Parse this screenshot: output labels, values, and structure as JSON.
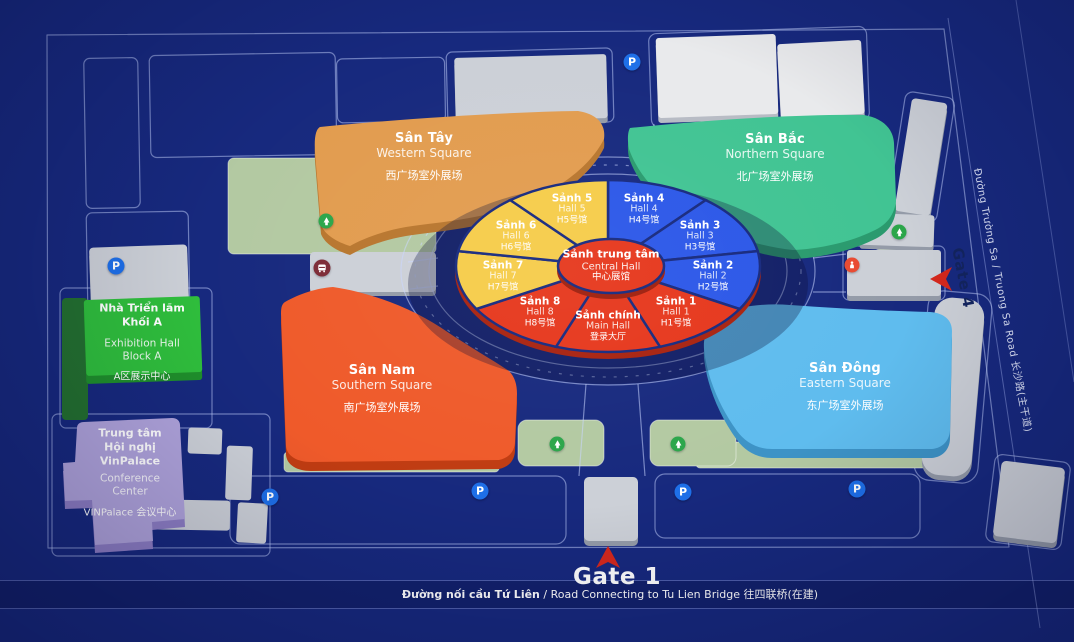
{
  "colors": {
    "background": "#17297E",
    "pie_blue": "#2B57E8",
    "pie_yellow": "#F6CC49",
    "pie_red": "#E6371C",
    "square_western": "#E29C4F",
    "square_northern": "#41C493",
    "square_southern": "#EF5A2A",
    "square_eastern": "#5FBCEE",
    "block_a_green": "#2FBE3C",
    "vinpalace_purple": "#AFA3DB",
    "parking_blue": "#1E6FE8",
    "tree_green": "#2BA64A",
    "gate_arrow_red": "#D5281C"
  },
  "central_hub": {
    "name": "Sảnh trung tâm",
    "en": "Central Hall",
    "cn": "中心展馆"
  },
  "halls": [
    {
      "id": "hall4",
      "name": "Sảnh 4",
      "en": "Hall 4",
      "cn": "H4号馆",
      "group": "blue",
      "start": 0,
      "end": 40
    },
    {
      "id": "hall3",
      "name": "Sảnh 3",
      "en": "Hall 3",
      "cn": "H3号馆",
      "group": "blue",
      "start": 40,
      "end": 80
    },
    {
      "id": "hall2",
      "name": "Sảnh 2",
      "en": "Hall 2",
      "cn": "H2号馆",
      "group": "blue",
      "start": 80,
      "end": 120
    },
    {
      "id": "hall1",
      "name": "Sảnh 1",
      "en": "Hall 1",
      "cn": "H1号馆",
      "group": "red",
      "start": 120,
      "end": 160
    },
    {
      "id": "main-hall",
      "name": "Sảnh chính",
      "en": "Main Hall",
      "cn": "登录大厅",
      "group": "red",
      "start": 160,
      "end": 200
    },
    {
      "id": "hall8",
      "name": "Sảnh 8",
      "en": "Hall 8",
      "cn": "H8号馆",
      "group": "red",
      "start": 200,
      "end": 240
    },
    {
      "id": "hall7",
      "name": "Sảnh 7",
      "en": "Hall 7",
      "cn": "H7号馆",
      "group": "yellow",
      "start": 240,
      "end": 280
    },
    {
      "id": "hall6",
      "name": "Sảnh 6",
      "en": "Hall 6",
      "cn": "H6号馆",
      "group": "yellow",
      "start": 280,
      "end": 320
    },
    {
      "id": "hall5",
      "name": "Sảnh 5",
      "en": "Hall 5",
      "cn": "H5号馆",
      "group": "yellow",
      "start": 320,
      "end": 360
    }
  ],
  "squares": {
    "western": {
      "name": "Sân Tây",
      "en": "Western Square",
      "cn": "西广场室外展场"
    },
    "northern": {
      "name": "Sân Bắc",
      "en": "Northern Square",
      "cn": "北广场室外展场"
    },
    "southern": {
      "name": "Sân Nam",
      "en": "Southern Square",
      "cn": "南广场室外展场"
    },
    "eastern": {
      "name": "Sân Đông",
      "en": "Eastern Square",
      "cn": "东广场室外展场"
    }
  },
  "buildings": {
    "block_a": {
      "name_line1": "Nhà Triển lãm",
      "name_line2": "Khối A",
      "en_line1": "Exhibition Hall",
      "en_line2": "Block A",
      "cn": "A区展示中心"
    },
    "vinpalace": {
      "name_line1": "Trung tâm",
      "name_line2": "Hội nghị",
      "name_line3": "VinPalace",
      "en_line1": "Conference",
      "en_line2": "Center",
      "cn": "VINPalace 会议中心"
    }
  },
  "gates": {
    "gate1": "Gate 1",
    "gate4": "Gate 4"
  },
  "roads": {
    "bottom_bold": "Đường nối cầu Tứ Liên",
    "bottom_rest": " / Road Connecting to Tu Lien Bridge 往四联桥(在建)",
    "right_side": "Đường Trường Sa / Truong Sa Road 长沙路(主干道)"
  },
  "map_icons": {
    "parking_letter": "P"
  }
}
